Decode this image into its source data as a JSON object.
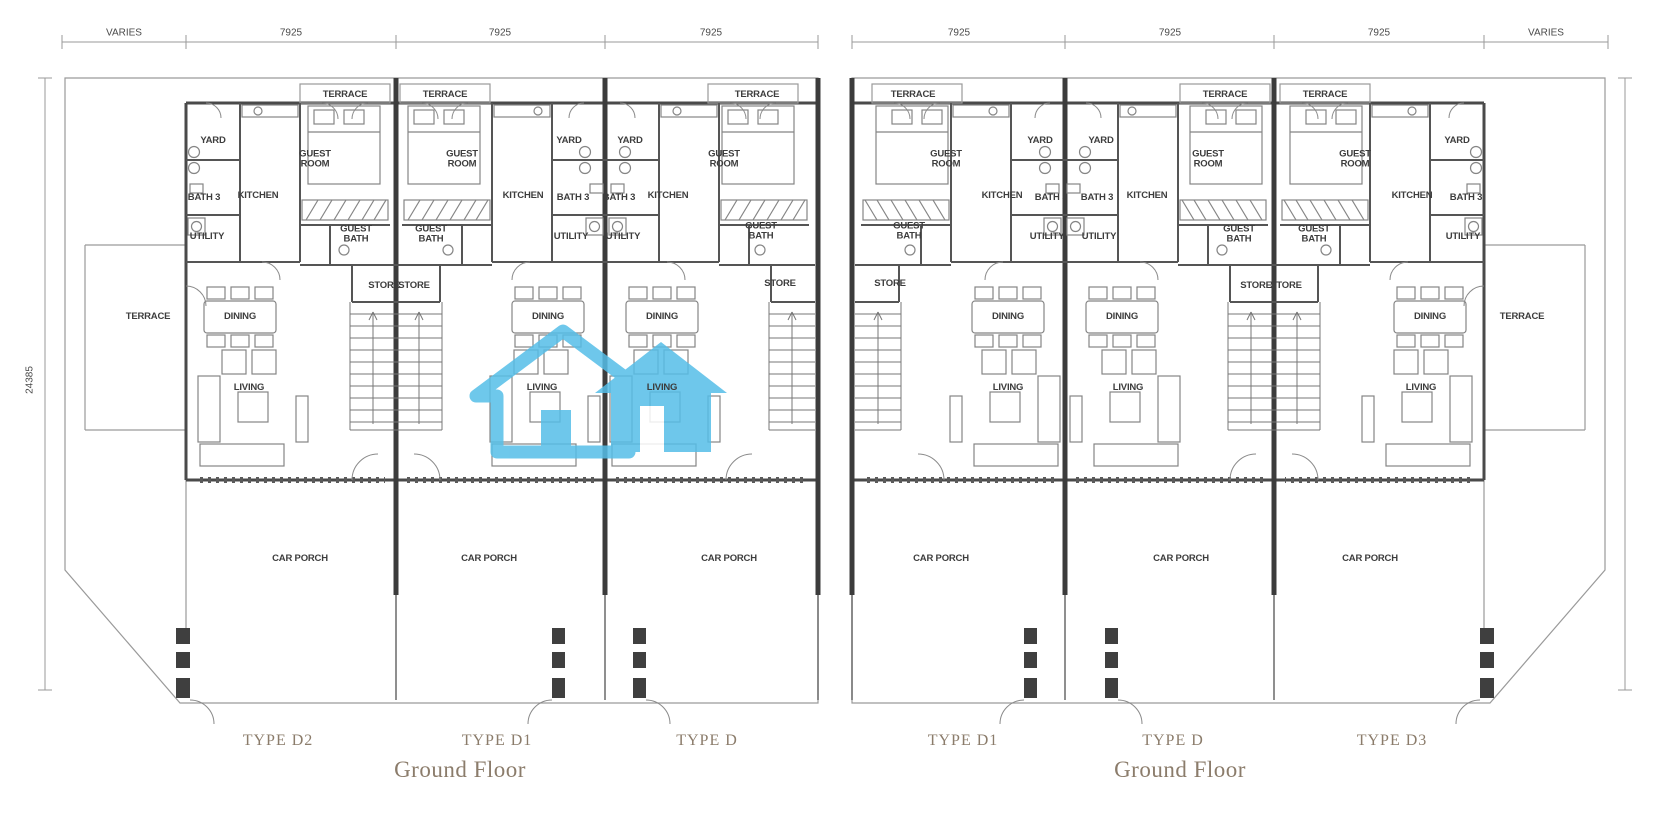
{
  "document": {
    "kind": "floor-plan-drawing"
  },
  "dimensions": {
    "varies": "VARIES",
    "bay_width": "7925",
    "block_depth": "24385"
  },
  "rooms": {
    "terrace": "TERRACE",
    "yard": "YARD",
    "guest_room": "GUEST ROOM",
    "kitchen": "KITCHEN",
    "bath3": "BATH 3",
    "utility": "UTILITY",
    "guest_bath": "GUEST BATH",
    "store": "STORE",
    "dining": "DINING",
    "living": "LIVING",
    "car_porch": "CAR PORCH"
  },
  "footer": {
    "left_types": [
      "TYPE D2",
      "TYPE D1",
      "TYPE D"
    ],
    "right_types": [
      "TYPE D1",
      "TYPE D",
      "TYPE D3"
    ],
    "floor": "Ground Floor"
  },
  "colors": {
    "watermark": "#55bee8",
    "footer_text": "#8b7c6b",
    "wall": "#4a4a4a",
    "party_wall": "#3c3c3c",
    "thin_line": "#9a9a9a"
  }
}
